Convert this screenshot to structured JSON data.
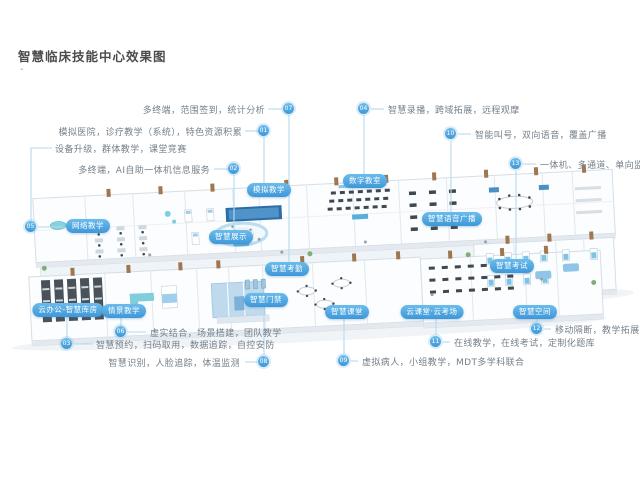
{
  "page": {
    "title": "智慧临床技能中心效果图",
    "subtitle_mark": "-"
  },
  "colors": {
    "accent": "#4aa5e0",
    "accent_dark": "#3b97d6",
    "connector": "#b5d9f0",
    "text_muted": "#75808a",
    "title_text": "#4c4c4c"
  },
  "area_labels": [
    {
      "label": "模拟教学"
    },
    {
      "label": "智慧展示"
    },
    {
      "label": "云办公-智慧库房"
    },
    {
      "label": "数字教室"
    },
    {
      "label": "网络教学"
    },
    {
      "label": "情景教学"
    },
    {
      "label": "智慧考勤"
    },
    {
      "label": "智慧门禁"
    },
    {
      "label": "智慧课堂"
    },
    {
      "label": "智慧语音广播"
    },
    {
      "label": "云课堂·云考场"
    },
    {
      "label": "智慧空间"
    },
    {
      "label": "智慧考试"
    }
  ],
  "callouts": [
    {
      "num": "01",
      "text": "模拟医院，诊疗教学（系统），特色资源积累"
    },
    {
      "num": "02",
      "text": "多终端，AI自助一体机信息服务"
    },
    {
      "num": "03",
      "text": "智慧预约，扫码取用，数据追踪，自控安防"
    },
    {
      "num": "04",
      "text": "智慧录播，跨域拓展，远程观摩"
    },
    {
      "num": "05",
      "text": "设备升级，群体教学，课堂竞赛"
    },
    {
      "num": "06",
      "text": "虚实结合，场景搭建，团队教学"
    },
    {
      "num": "07",
      "text": "多终端，范围签到，统计分析"
    },
    {
      "num": "08",
      "text": "智慧识别，人脸追踪，体温监测"
    },
    {
      "num": "09",
      "text": "虚拟病人，小组教学，MDT多学科联合"
    },
    {
      "num": "10",
      "text": "智能叫号，双向语音，覆盖广播"
    },
    {
      "num": "11",
      "text": "在线教学，在线考试，定制化题库"
    },
    {
      "num": "12",
      "text": "移动隔断，教学拓展"
    },
    {
      "num": "13",
      "text": "一体机、多通道、单向监考"
    }
  ]
}
